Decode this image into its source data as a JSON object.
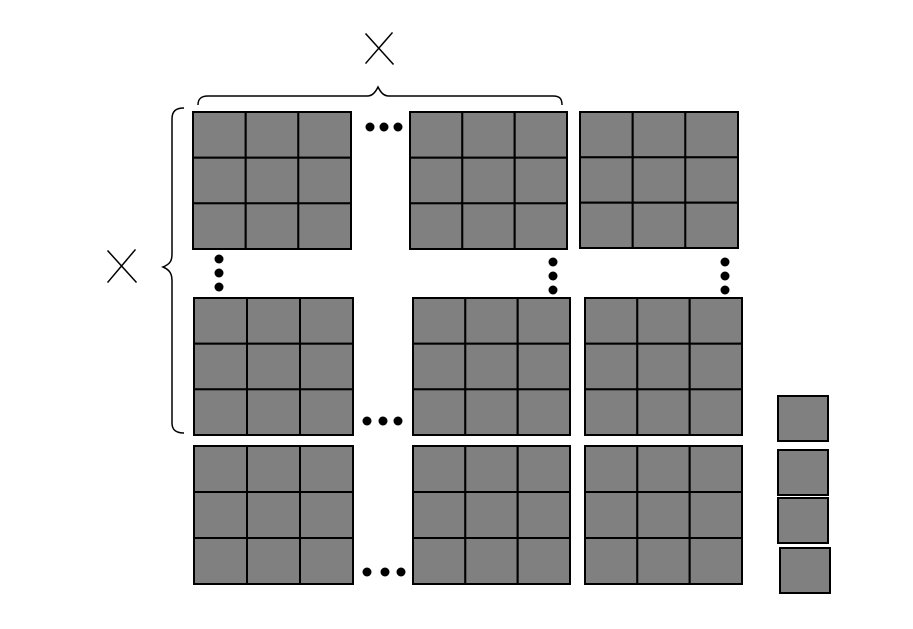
{
  "diagram": {
    "type": "block-matrix-figure",
    "canvas": {
      "width": 913,
      "height": 629,
      "background": "#ffffff"
    },
    "style": {
      "block_fill": "#808080",
      "stroke_color": "#000000",
      "cell_stroke_width": 2,
      "line_stroke_width": 1.5,
      "dot_color": "#000000",
      "dot_radius": 4.5
    },
    "times_symbol": "×",
    "crosses": [
      {
        "id": "times-symbol-top",
        "lines": [
          [
            366,
            34,
            393,
            64
          ],
          [
            392,
            33,
            366,
            63
          ]
        ]
      },
      {
        "id": "times-symbol-left",
        "lines": [
          [
            108,
            251,
            136,
            282
          ],
          [
            135,
            250,
            108,
            282
          ]
        ]
      }
    ],
    "braces": [
      {
        "id": "width-brace",
        "path": "M 198 105 C 198 99 201 96 208 96 L 367 96 C 372 96 375 93 378 87 C 381 93 384 96 389 96 L 553 96 C 560 96 562 99 562 105"
      },
      {
        "id": "height-brace",
        "path": "M 184 108 C 176 108 172 111 172 119 L 172 254 C 172 261 170 264 163 267 C 170 270 172 274 172 281 L 172 423 C 172 430 176 433 184 433"
      }
    ],
    "blocks": [
      {
        "x": 193,
        "y": 112,
        "w": 158,
        "h": 137,
        "rows": 3,
        "cols": 3
      },
      {
        "x": 410,
        "y": 112,
        "w": 157,
        "h": 137,
        "rows": 3,
        "cols": 3
      },
      {
        "x": 580,
        "y": 112,
        "w": 158,
        "h": 136,
        "rows": 3,
        "cols": 3
      },
      {
        "x": 194,
        "y": 298,
        "w": 159,
        "h": 137,
        "rows": 3,
        "cols": 3
      },
      {
        "x": 413,
        "y": 298,
        "w": 157,
        "h": 137,
        "rows": 3,
        "cols": 3
      },
      {
        "x": 585,
        "y": 298,
        "w": 157,
        "h": 137,
        "rows": 3,
        "cols": 3
      },
      {
        "x": 194,
        "y": 446,
        "w": 159,
        "h": 138,
        "rows": 3,
        "cols": 3
      },
      {
        "x": 413,
        "y": 446,
        "w": 157,
        "h": 138,
        "rows": 3,
        "cols": 3
      },
      {
        "x": 585,
        "y": 446,
        "w": 157,
        "h": 138,
        "rows": 3,
        "cols": 3
      }
    ],
    "unit_squares": [
      {
        "x": 778,
        "y": 396,
        "w": 50,
        "h": 45
      },
      {
        "x": 778,
        "y": 450,
        "w": 50,
        "h": 45
      },
      {
        "x": 778,
        "y": 498,
        "w": 50,
        "h": 45
      },
      {
        "x": 780,
        "y": 548,
        "w": 50,
        "h": 45
      }
    ],
    "h_ellipses": [
      {
        "y": 127,
        "xs": [
          370,
          384,
          398
        ]
      },
      {
        "y": 421,
        "xs": [
          367,
          383,
          398
        ]
      },
      {
        "y": 572,
        "xs": [
          367,
          385,
          401
        ]
      }
    ],
    "v_ellipses": [
      {
        "x": 219,
        "ys": [
          259,
          273,
          287
        ]
      },
      {
        "x": 553,
        "ys": [
          262,
          276,
          290
        ]
      },
      {
        "x": 725,
        "ys": [
          262,
          276,
          290
        ]
      }
    ]
  }
}
